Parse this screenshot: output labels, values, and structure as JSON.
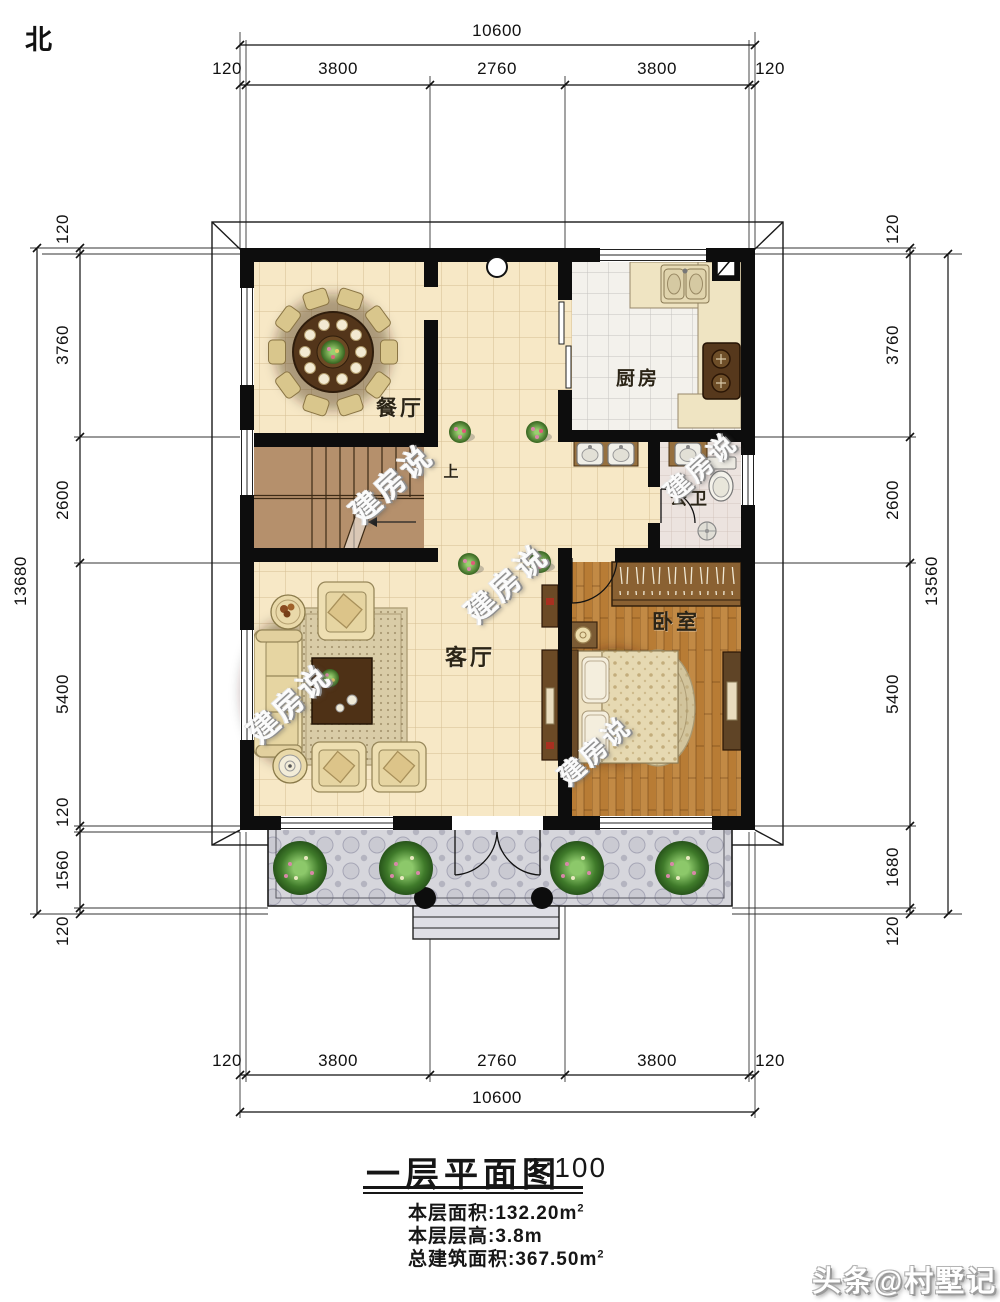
{
  "compass": {
    "north": "北"
  },
  "dimensions": {
    "top": {
      "overall": "10600",
      "segments": [
        "120",
        "3800",
        "2760",
        "3800",
        "120"
      ]
    },
    "bottom": {
      "overall": "10600",
      "segments": [
        "120",
        "3800",
        "2760",
        "3800",
        "120"
      ]
    },
    "left": {
      "overall": "13680",
      "segments": [
        "120",
        "3760",
        "2600",
        "5400",
        "120",
        "1560",
        "120"
      ]
    },
    "right": {
      "overall": "13560",
      "segments": [
        "120",
        "3760",
        "2600",
        "5400",
        "1680",
        "120"
      ]
    }
  },
  "rooms": {
    "dining": "餐厅",
    "kitchen": "厨房",
    "bathroom": "公卫",
    "living": "客厅",
    "bedroom": "卧室",
    "stairs_up": "上"
  },
  "watermark": {
    "text": "建房说"
  },
  "title_block": {
    "title": "一层平面图",
    "scale": "1:100",
    "floor_area_label": "本层面积:132.20m",
    "floor_area_sup": "2",
    "floor_height_label": "本层层高:3.8m",
    "total_area_label": "总建筑面积:367.50m",
    "total_area_sup": "2"
  },
  "credit": {
    "text": "头条@村墅记"
  },
  "colors": {
    "wall": "#0d0d0d",
    "floor_tile": "#f7e8c6",
    "kitchen_tile": "#f3f1ec",
    "bath_tile": "#ece3df",
    "wood_floor": "#c08440",
    "stair_wood": "#b5906c",
    "porch_tile": "#d6d6dc",
    "plant_green": "#3f7a2a"
  }
}
